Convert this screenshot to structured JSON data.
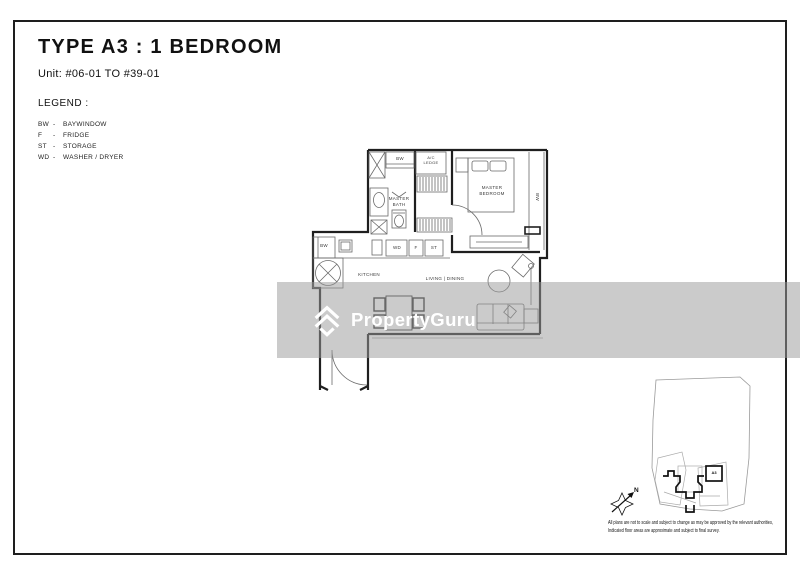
{
  "header": {
    "title": "TYPE A3 : 1 BEDROOM",
    "unit_range": "Unit: #06-01 TO #39-01"
  },
  "legend": {
    "heading": "LEGEND :",
    "separator": "-",
    "items": [
      {
        "abbr": "BW",
        "label": "BAYWINDOW"
      },
      {
        "abbr": "F",
        "label": "FRIDGE"
      },
      {
        "abbr": "ST",
        "label": "STORAGE"
      },
      {
        "abbr": "WD",
        "label": "WASHER / DRYER"
      }
    ]
  },
  "floorplan": {
    "labels": {
      "bw_top": "BW",
      "ac_ledge": "A/C LEDGE",
      "master_bath": "MASTER BATH",
      "master_bedroom": "MASTER BEDROOM",
      "bw_right": "BW",
      "bw_kitchen": "BW",
      "washer_dryer": "WD",
      "fridge": "F",
      "storage": "ST",
      "kitchen": "KITCHEN",
      "living_dining": "LIVING | DINING"
    }
  },
  "watermark": {
    "brand": "PropertyGuru"
  },
  "siteplan": {
    "north_label": "N",
    "unit_marker": "A3"
  },
  "disclaimer": {
    "line1": "All plans are not to scale and subject to change as may be approved by the relevant authorities,",
    "line2": "Indicated floor areas are approximate and subject to final survey."
  }
}
